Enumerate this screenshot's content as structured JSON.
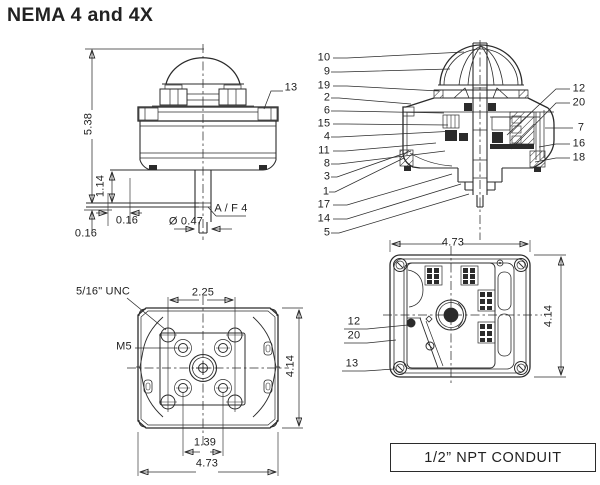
{
  "title": "NEMA 4 and 4X",
  "conduit_box": {
    "label": "1/2” NPT CONDUIT"
  },
  "side_view": {
    "overall_height": "5.38",
    "bracket_height": "1.14",
    "base_offset": "0.16",
    "plate_offset": "0.16",
    "shaft_diameter": "Ø 0.47",
    "across_flats": "A / F 4",
    "callout": "13"
  },
  "cutaway_view": {
    "left_callouts": [
      "10",
      "9",
      "19",
      "2",
      "6",
      "15",
      "4",
      "11",
      "8",
      "3",
      "1",
      "17",
      "14",
      "5"
    ],
    "right_callouts": [
      "12",
      "20",
      "7",
      "16",
      "18"
    ]
  },
  "bottom_view": {
    "thread_label": "5/16\" UNC",
    "metric_thread_label": "M5",
    "bolt_spacing": "2.25",
    "stud_spacing": "1.39",
    "width": "4.73",
    "depth": "4.14"
  },
  "open_view": {
    "width": "4.73",
    "depth": "4.14",
    "callouts": [
      "12",
      "20",
      "13"
    ]
  }
}
